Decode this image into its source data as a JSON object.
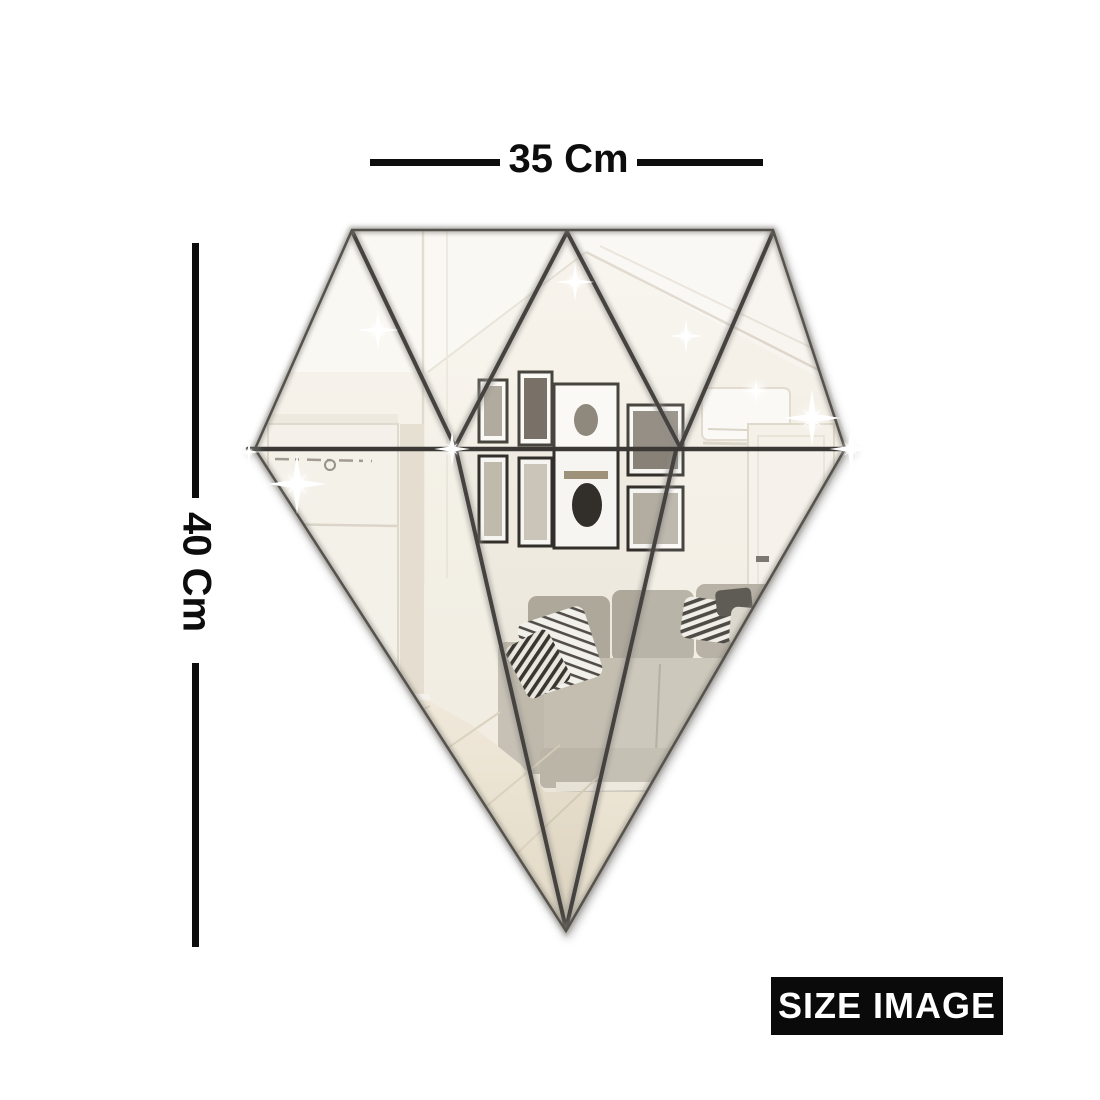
{
  "page": {
    "background": "#ffffff"
  },
  "dimensions": {
    "width_label": "35 Cm",
    "height_label": "40 Cm"
  },
  "badge": {
    "label": "SIZE IMAGE",
    "bg": "#0a0a0a",
    "text_color": "#ffffff"
  },
  "mirror": {
    "shape": "diamond",
    "top_row_facets": 5,
    "bottom_facets": 3,
    "total_pieces": 8,
    "tint": "#ece5d6",
    "groove_color": "#45433f",
    "dimension_line_color": "#0d0d0d",
    "reflection_scene": "living room with gray sofa, striped pillows, framed wall pictures, white doors, air conditioner and ceiling spotlights",
    "sparkle_count": 9
  }
}
